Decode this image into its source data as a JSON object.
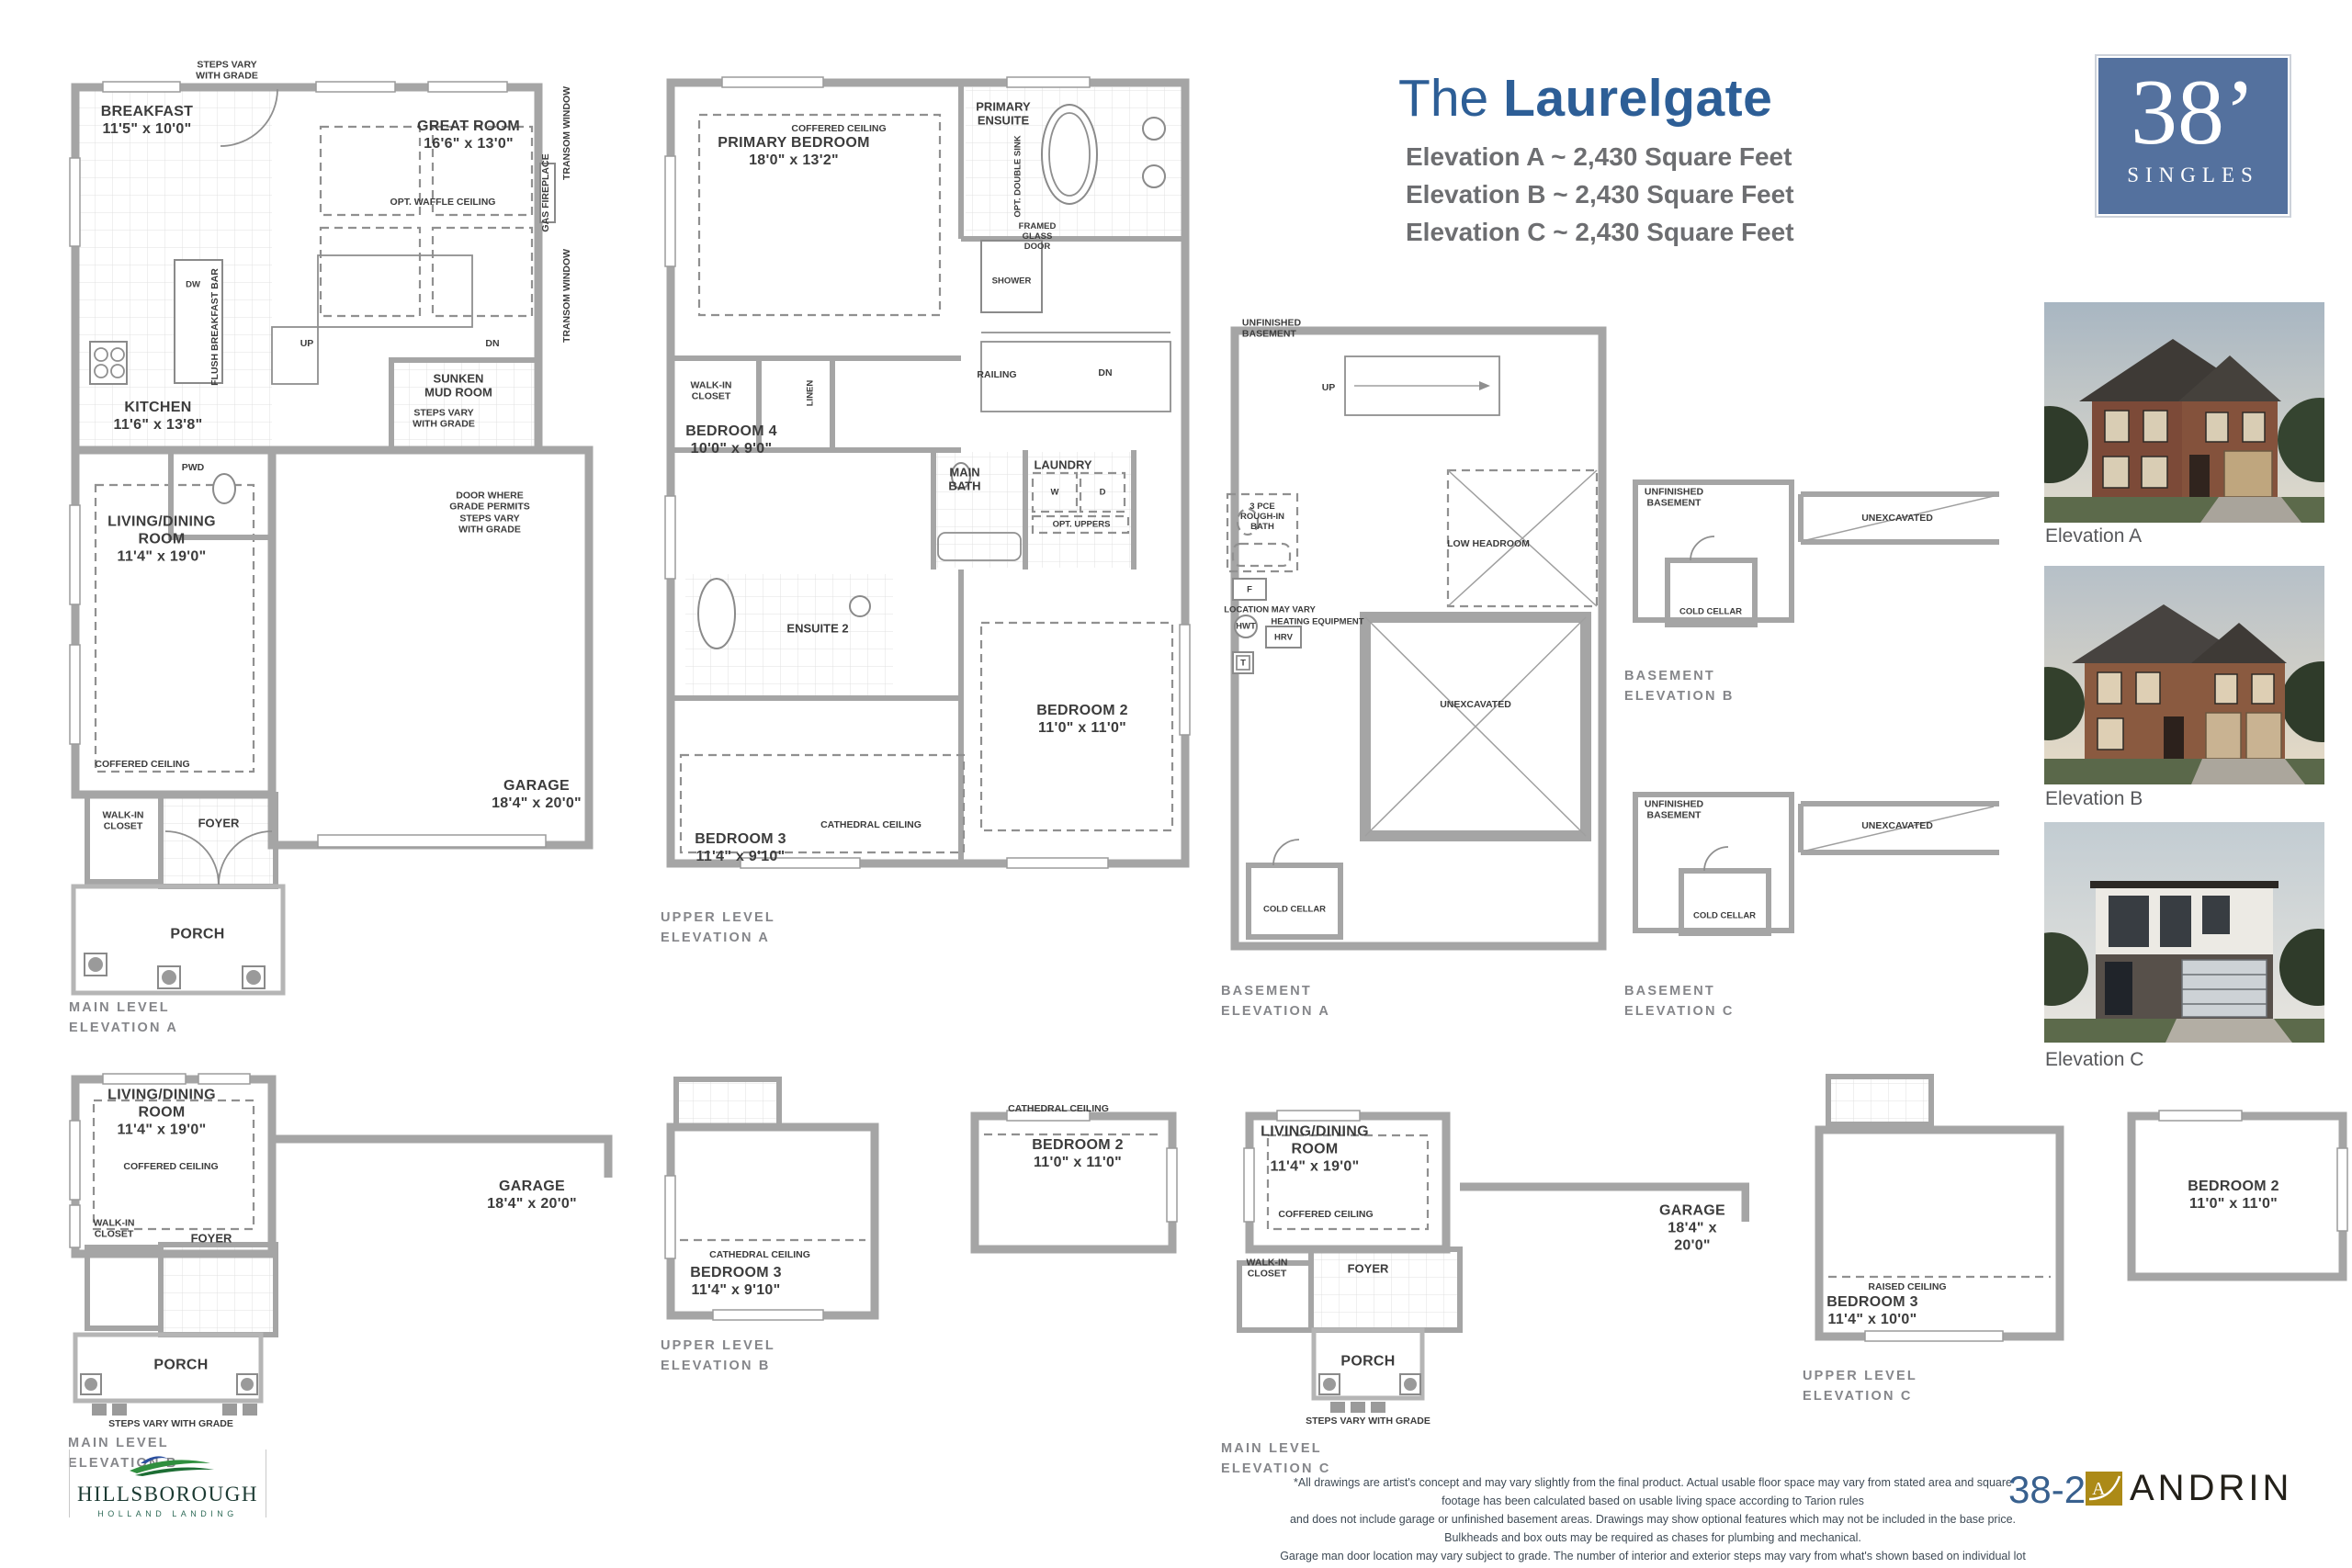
{
  "header": {
    "title_prefix": "The",
    "title_name": "Laurelgate",
    "subtitle_a": "Elevation A ~ 2,430 Square Feet",
    "subtitle_b": "Elevation B ~ 2,430 Square Feet",
    "subtitle_c": "Elevation C ~ 2,430 Square Feet",
    "accent_color": "#2d5e96"
  },
  "badge": {
    "size": "38’",
    "type": "SINGLES",
    "bg_color": "#54719e"
  },
  "plans": {
    "main_a": {
      "caption": "MAIN LEVEL\nELEVATION A",
      "steps_top": "STEPS VARY\nWITH GRADE",
      "breakfast": "BREAKFAST\n11'5\" x 10'0\"",
      "great_room": "GREAT ROOM\n16'6\" x 13'0\"",
      "opt_waffle_ceiling": "OPT. WAFFLE CEILING",
      "gas_fireplace": "GAS FIREPLACE",
      "transom_window_top": "TRANSOM WINDOW",
      "transom_window_mid": "TRANSOM WINDOW",
      "dw": "DW",
      "flush_breakfast_bar": "FLUSH BREAKFAST BAR",
      "up": "UP",
      "dn": "DN",
      "kitchen": "KITCHEN\n11'6\" x 13'8\"",
      "sunken_mud_room": "SUNKEN\nMUD ROOM",
      "steps_mid": "STEPS VARY\nWITH GRADE",
      "pwd": "PWD",
      "door_grade": "DOOR WHERE\nGRADE PERMITS\nSTEPS VARY\nWITH GRADE",
      "living": "LIVING/DINING\nROOM\n11'4\" x 19'0\"",
      "coffered_ceiling": "COFFERED CEILING",
      "garage": "GARAGE\n18'4\" x 20'0\"",
      "walk_in_closet": "WALK-IN\nCLOSET",
      "foyer": "FOYER",
      "porch": "PORCH"
    },
    "upper_a": {
      "caption": "UPPER LEVEL\nELEVATION A",
      "coffered_ceiling": "COFFERED CEILING",
      "primary_bedroom": "PRIMARY BEDROOM\n18'0\" x 13'2\"",
      "primary_ensuite": "PRIMARY\nENSUITE",
      "opt_double_sink": "OPT. DOUBLE SINK",
      "framed_glass_door": "FRAMED\nGLASS\nDOOR",
      "shower": "SHOWER",
      "walk_in_closet": "WALK-IN\nCLOSET",
      "linen": "LINEN",
      "bedroom4": "BEDROOM 4\n10'0\" x 9'0\"",
      "railing": "RAILING",
      "dn": "DN",
      "main_bath": "MAIN\nBATH",
      "laundry": "LAUNDRY",
      "w": "W",
      "d": "D",
      "opt_uppers": "OPT. UPPERS",
      "ensuite2": "ENSUITE 2",
      "bedroom2": "BEDROOM 2\n11'0\" x 11'0\"",
      "cathedral_ceiling": "CATHEDRAL CEILING",
      "bedroom3": "BEDROOM 3\n11'4\" x 9'10\""
    },
    "basement_a": {
      "caption": "BASEMENT\nELEVATION A",
      "unfinished": "UNFINISHED\nBASEMENT",
      "up": "UP",
      "three_pce": "3 PCE\nROUGH-IN\nBATH",
      "low_headroom": "LOW HEADROOM",
      "f": "F",
      "location_may_vary": "LOCATION MAY VARY",
      "hwt": "HWT",
      "heating_equipment": "HEATING EQUIPMENT",
      "hrv": "HRV",
      "t": "T",
      "unexcavated": "UNEXCAVATED",
      "cold_cellar": "COLD CELLAR"
    },
    "basement_b": {
      "caption": "BASEMENT\nELEVATION B",
      "unfinished": "UNFINISHED\nBASEMENT",
      "unexcavated": "UNEXCAVATED",
      "cold_cellar": "COLD CELLAR"
    },
    "basement_c": {
      "caption": "BASEMENT\nELEVATION C",
      "unfinished": "UNFINISHED\nBASEMENT",
      "unexcavated": "UNEXCAVATED",
      "cold_cellar": "COLD CELLAR"
    },
    "main_b": {
      "caption": "MAIN LEVEL\nELEVATION B",
      "living": "LIVING/DINING\nROOM\n11'4\" x 19'0\"",
      "coffered_ceiling": "COFFERED CEILING",
      "garage": "GARAGE\n18'4\" x 20'0\"",
      "walk_in_closet": "WALK-IN\nCLOSET",
      "foyer": "FOYER",
      "porch": "PORCH",
      "steps": "STEPS VARY WITH GRADE"
    },
    "upper_b": {
      "caption": "UPPER LEVEL\nELEVATION B",
      "cathedral_ceiling_right": "CATHEDRAL CEILING",
      "bedroom2": "BEDROOM 2\n11'0\" x 11'0\"",
      "cathedral_ceiling_left": "CATHEDRAL CEILING",
      "bedroom3": "BEDROOM 3\n11'4\" x 9'10\""
    },
    "main_c": {
      "caption": "MAIN LEVEL\nELEVATION C",
      "living": "LIVING/DINING\nROOM\n11'4\" x 19'0\"",
      "coffered_ceiling": "COFFERED CEILING",
      "garage": "GARAGE\n18'4\" x 20'0\"",
      "walk_in_closet": "WALK-IN\nCLOSET",
      "foyer": "FOYER",
      "porch": "PORCH",
      "steps": "STEPS VARY WITH GRADE"
    },
    "upper_c": {
      "caption": "UPPER LEVEL\nELEVATION C",
      "bedroom2": "BEDROOM 2\n11'0\" x 11'0\"",
      "raised_ceiling": "RAISED CEILING",
      "bedroom3": "BEDROOM 3\n11'4\" x 10'0\""
    }
  },
  "elevations": {
    "a": "Elevation A",
    "b": "Elevation B",
    "c": "Elevation C"
  },
  "footer": {
    "community": "HILLSBOROUGH",
    "community_tagline": "HOLLAND LANDING",
    "disclaimer_line1": "*All drawings are artist's concept and may vary slightly from the final product. Actual usable floor space may vary from stated area and square footage has been calculated based on usable living space according to Tarion rules",
    "disclaimer_line2": "and does not include garage or unfinished basement areas. Drawings may show optional features which may not be included in the base price. Bulkheads and box outs may be required as chases for plumbing and mechanical.",
    "disclaimer_line3": "Garage man door location may vary subject to grade. The number of interior and exterior steps may vary from what's shown based on individual lot grading conditions. E. & O. E. _RFCC20200417_20230619_IFS",
    "page_code": "38-2",
    "builder": "ANDRIN",
    "builder_gold": "#ac8a17"
  }
}
